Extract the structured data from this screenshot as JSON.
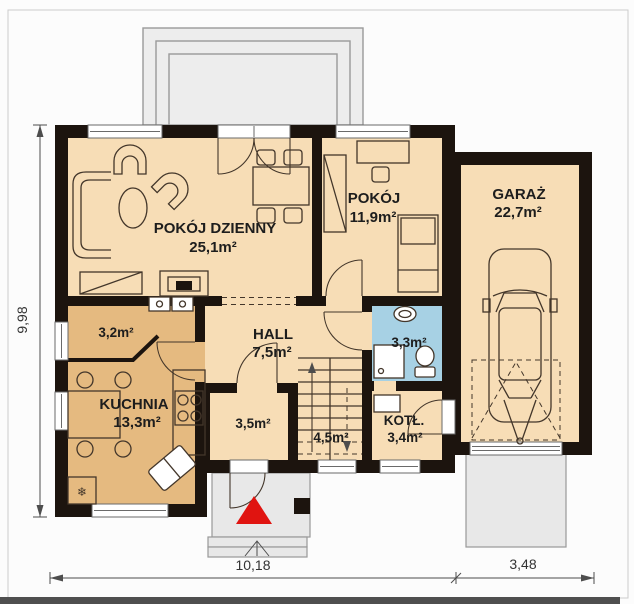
{
  "plan": {
    "rooms": {
      "living": {
        "name": "POKÓJ DZIENNY",
        "area": "25,1m²"
      },
      "bedroom": {
        "name": "POKÓJ",
        "area": "11,9m²"
      },
      "garage": {
        "name": "GARAŻ",
        "area": "22,7m²"
      },
      "hall": {
        "name": "HALL",
        "area": "7,5m²"
      },
      "kitchen": {
        "name": "KUCHNIA",
        "area": "13,3m²"
      },
      "pantry": {
        "area": "3,2m²"
      },
      "bathroom": {
        "area": "3,3m²"
      },
      "closet": {
        "area": "3,5m²"
      },
      "stairs": {
        "area": "4,5m²"
      },
      "boiler": {
        "name": "KOTŁ.",
        "area": "3,4m²"
      }
    },
    "dimensions": {
      "height": "9,98",
      "width_house": "10,18",
      "width_garage": "3,48"
    },
    "symbols": {
      "fridge": "❄"
    },
    "colors": {
      "wall": "#1c140e",
      "room": "#f7ddb6",
      "kitchen": "#e5ba80",
      "bath": "#a7d1e4",
      "terrace": "#ededed",
      "porch": "#e8e8e8",
      "red": "#e01410",
      "line": "#43362a",
      "dim": "#4d4d4d",
      "bg": "#fcfcfc"
    }
  }
}
